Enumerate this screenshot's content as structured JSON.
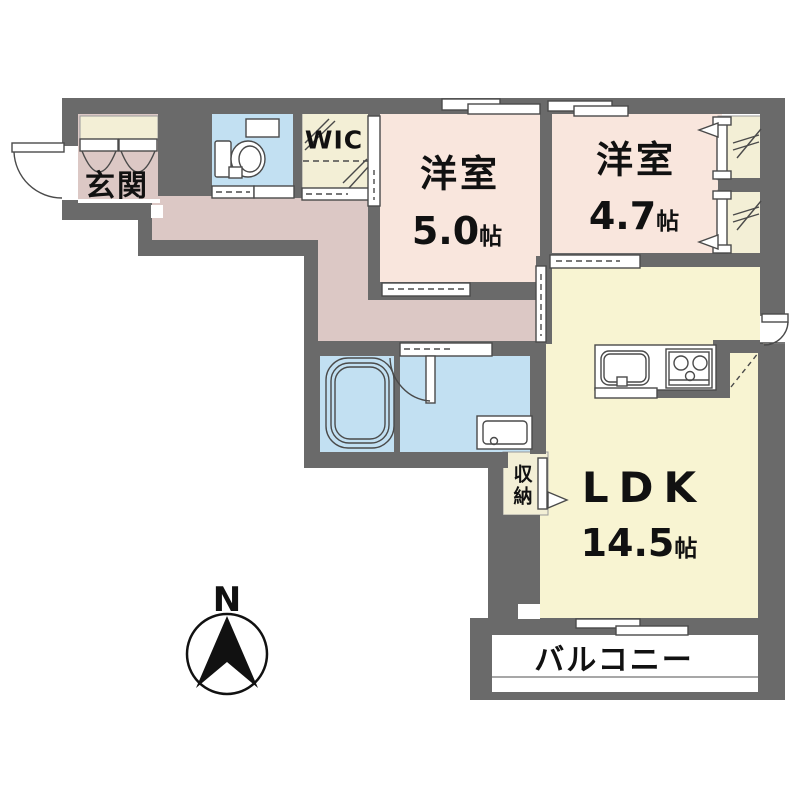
{
  "plan": {
    "title": "apartment floor plan",
    "entrance": {
      "label": "玄関"
    },
    "wic": {
      "label": "WIC"
    },
    "bedroom1": {
      "name": "洋室",
      "size": "5.0",
      "unit": "帖"
    },
    "bedroom2": {
      "name": "洋室",
      "size": "4.7",
      "unit": "帖"
    },
    "ldk": {
      "name": "LDK",
      "size": "14.5",
      "unit": "帖"
    },
    "storage": {
      "label": "収納"
    },
    "balcony": {
      "label": "バルコニー"
    },
    "compass": {
      "label": "N"
    }
  },
  "colors": {
    "wall": "#6a6a6a",
    "hall_floor": "#dcc8c5",
    "bedroom_floor": "#f9e6dd",
    "ldk_floor": "#f8f4d2",
    "closet_floor": "#f3efd6",
    "wet_floor": "#c2e0f2",
    "balcony_floor": "#ffffff",
    "line": "#4a4a4a",
    "text": "#111111"
  }
}
